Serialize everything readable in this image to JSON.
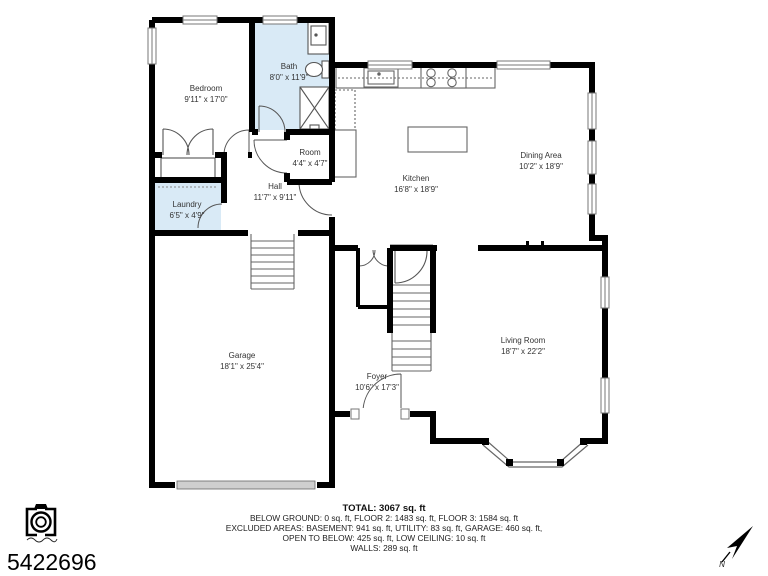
{
  "floor_plan": {
    "rooms": [
      {
        "id": "bedroom",
        "name": "Bedroom",
        "dims": "9'11\" x 17'0\""
      },
      {
        "id": "bath",
        "name": "Bath",
        "dims": "8'0\" x 11'9\""
      },
      {
        "id": "room",
        "name": "Room",
        "dims": "4'4\" x 4'7\""
      },
      {
        "id": "hall",
        "name": "Hall",
        "dims": "11'7\" x 9'11\""
      },
      {
        "id": "laundry",
        "name": "Laundry",
        "dims": "6'5\" x 4'9\""
      },
      {
        "id": "kitchen",
        "name": "Kitchen",
        "dims": "16'8\" x 18'9\""
      },
      {
        "id": "dining",
        "name": "Dining Area",
        "dims": "10'2\" x 18'9\""
      },
      {
        "id": "garage",
        "name": "Garage",
        "dims": "18'1\" x 25'4\""
      },
      {
        "id": "foyer",
        "name": "Foyer",
        "dims": "10'6\" x 17'3\""
      },
      {
        "id": "living",
        "name": "Living Room",
        "dims": "18'7\" x 22'2\""
      }
    ],
    "compass_label": "N",
    "colors": {
      "wall": "#000000",
      "highlight": "#d9eaf6"
    }
  },
  "summary": {
    "total": "TOTAL: 3067 sq. ft",
    "line1": "BELOW GROUND: 0 sq. ft, FLOOR 2: 1483 sq. ft, FLOOR 3: 1584 sq. ft",
    "line2": "EXCLUDED AREAS: BASEMENT: 941 sq. ft, UTILITY: 83 sq. ft, GARAGE: 460 sq. ft,",
    "line3": "OPEN TO BELOW: 425 sq. ft, LOW CEILING: 10 sq. ft",
    "line4": "WALLS: 289 sq. ft"
  },
  "listing": {
    "id": "5422696"
  },
  "icons": {
    "camera_logo": "camera-logo-icon",
    "north_arrow": "north-arrow-icon"
  }
}
